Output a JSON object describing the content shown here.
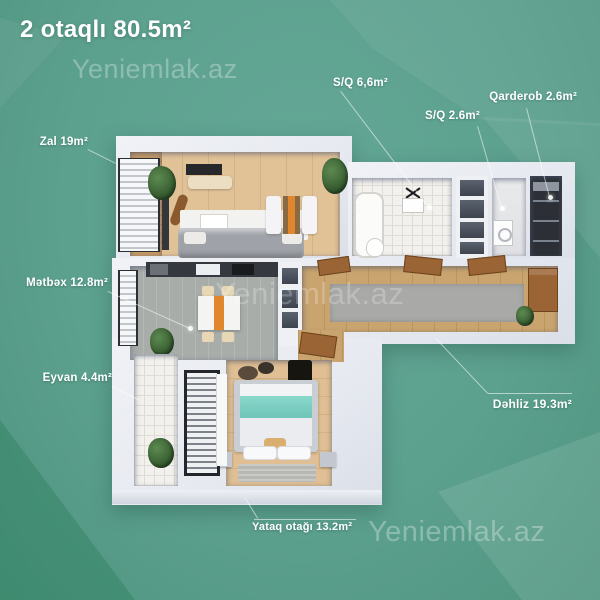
{
  "header": {
    "title": "2 otaqlı 80.5m²"
  },
  "watermarks": {
    "top": "Yeniemlak.az",
    "center": "Yeniemlak.az",
    "bottom": "Yeniemlak.az"
  },
  "room_labels": {
    "zal": "Zal 19m²",
    "metbex": "Mətbəx 12.8m²",
    "eyvan": "Eyvan 4.4m²",
    "yataq": "Yataq otağı 13.2m²",
    "dehliz": "Dəhliz 19.3m²",
    "sq_large": "S/Q 6,6m²",
    "sq_small": "S/Q 2.6m²",
    "qarderob": "Qarderob 2.6m²"
  },
  "colors": {
    "background": "#5CA08E",
    "background_bright": "#3E9478",
    "background_light": "#74AC9C",
    "wall": "#E9ECF2",
    "wood_light": "#E1C297",
    "wood_dark": "#C69A66",
    "hall_wood": "#C9A46E",
    "kitchen_floor": "#A8ADA9",
    "tile": "#F2F1ED",
    "rug_gray": "#A9A9A7",
    "teal_blanket": "#7BCFC3",
    "door_brown": "#9A6434",
    "accent_orange": "#E0862C",
    "label_text": "#FFFFFF"
  }
}
